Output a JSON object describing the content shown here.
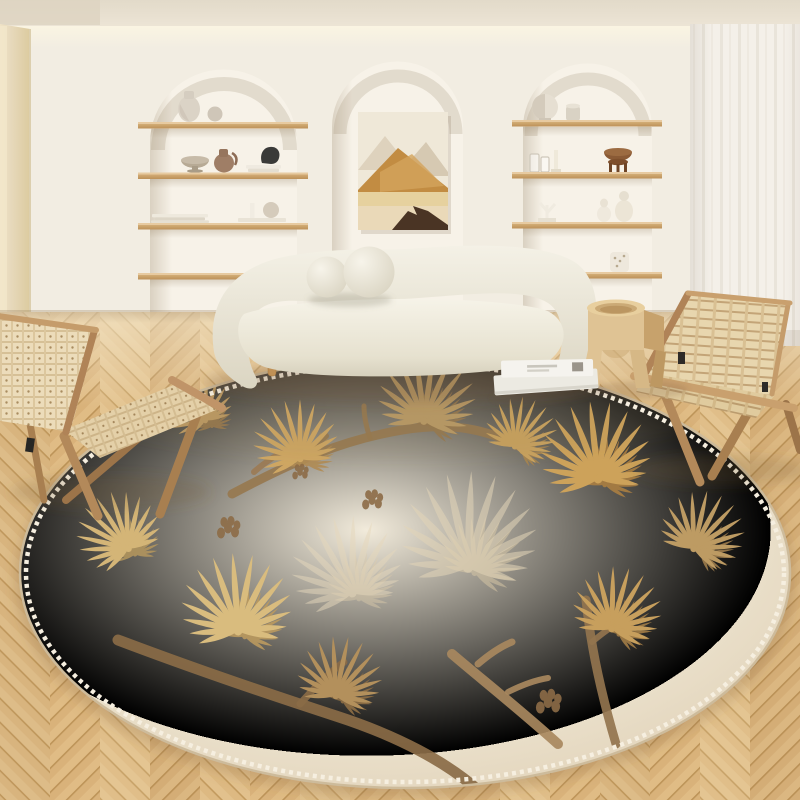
{
  "meta": {
    "description": "Lifestyle photo of a cream Japandi living room: arched wall niches with oak shelves and ceramics, abstract mountain canvas, curved boucle sofa with ball cushions, two wood folding lounge chairs with woven seats, carved wood stool, sheer curtain, herringbone oak parquet, and a large round cream rug with golden pine-branch motifs",
    "visible_text": "none"
  },
  "palette": {
    "ceiling": "#e8e0d1",
    "cove_glow": "#fbf5e2",
    "wall": "#f2ede2",
    "side_wall": "#e7d9bc",
    "niche": "#f7f2e8",
    "shelf_wood": "#cda46e",
    "curtain": "#f4f0e9",
    "floor_mid": "#ddb982",
    "floor_seam": "#c29a5e",
    "rug_base": "#eee5d2",
    "rug_stitch": "#f6efe0",
    "rug_gold": "#cda25a",
    "rug_tan": "#b3905c",
    "rug_brown": "#8a6b46",
    "sofa": "#ece7d9",
    "chair_wood": "#b3895a",
    "weave": "#ead9b6",
    "stool_wood": "#dfc394",
    "magazine": "#f1efe8",
    "art_rock": "#4a3424"
  },
  "objects": {
    "ceiling": {
      "label": "ceiling with recessed cove lighting"
    },
    "wall": {
      "label": "warm white plaster wall"
    },
    "side_wall": {
      "label": "beige side wall at left"
    },
    "niche_left": {
      "label": "arched wall niche with four oak shelves of ceramics",
      "shelves": [
        {
          "items": [
            "white ceramic vase",
            "small sphere vase"
          ]
        },
        {
          "items": [
            "footed stone bowl",
            "brown clay jug",
            "stack of white books",
            "dark abstract sculpture"
          ]
        },
        {
          "items": [
            "stack of books",
            "books with white candle and round vase"
          ]
        },
        {
          "items": [
            "empty shelf behind sofa"
          ]
        }
      ]
    },
    "niche_center": {
      "label": "arched niche with abstract canvas",
      "art": {
        "label": "abstract mountain landscape painting in ochre and cream",
        "colors": [
          "#efe8d8",
          "#ded2bd",
          "#c28c42",
          "#e6d19e",
          "#4a3424"
        ]
      }
    },
    "niche_right": {
      "label": "arched wall niche with four oak shelves of ceramics",
      "shelves": [
        {
          "items": [
            "round disc sculpture",
            "small white pot"
          ]
        },
        {
          "items": [
            "two glass cups",
            "white candle holder",
            "brown footed pedestal bowl"
          ]
        },
        {
          "items": [
            "white branch sculpture",
            "two white gourd vases"
          ]
        },
        {
          "items": [
            "white dotted cup"
          ]
        }
      ]
    },
    "curtain": {
      "label": "floor-length sheer curtain at right"
    },
    "floor": {
      "label": "light oak herringbone parquet floor"
    },
    "rug": {
      "label": "large round cream rug with golden pine branch motif",
      "edge": "whipstitch border",
      "motifs": [
        {
          "x": 300,
          "y": 458,
          "rot": -15,
          "scale": 1.0,
          "color": "#cfa763",
          "color2": "#b18c55"
        },
        {
          "x": 424,
          "y": 420,
          "rot": 8,
          "scale": 1.15,
          "color": "#b99a66",
          "color2": "#97794f"
        },
        {
          "x": 515,
          "y": 446,
          "rot": 24,
          "scale": 0.85,
          "color": "#c9a25f",
          "color2": "#a8854f"
        },
        {
          "x": 598,
          "y": 478,
          "rot": -6,
          "scale": 1.3,
          "color": "#cda25a",
          "color2": "#ab7f42"
        },
        {
          "x": 694,
          "y": 548,
          "rot": 28,
          "scale": 1.0,
          "color": "#bd9b63",
          "color2": "#9d7c4c"
        },
        {
          "x": 128,
          "y": 548,
          "rot": -32,
          "scale": 1.0,
          "color": "#d4b577",
          "color2": "#b2955e"
        },
        {
          "x": 238,
          "y": 630,
          "rot": -4,
          "scale": 1.3,
          "color": "#d9bc7e",
          "color2": "#bb9a5f"
        },
        {
          "x": 336,
          "y": 695,
          "rot": 12,
          "scale": 1.0,
          "color": "#b3905c",
          "color2": "#8f6f45"
        },
        {
          "x": 612,
          "y": 628,
          "rot": 16,
          "scale": 1.05,
          "color": "#c79f5d",
          "color2": "#a37d46"
        },
        {
          "x": 205,
          "y": 420,
          "rot": -28,
          "scale": 0.8,
          "color": "#bd9a64",
          "color2": "#9b7a4e"
        },
        {
          "x": 468,
          "y": 566,
          "rot": 2,
          "scale": 1.6,
          "color": "#e3d5b8",
          "color2": "#dccba8",
          "opacity": 0.55
        },
        {
          "x": 352,
          "y": 592,
          "rot": -14,
          "scale": 1.3,
          "color": "#e6d8bc",
          "color2": "#ddccab",
          "opacity": 0.5
        }
      ],
      "branches": [
        {
          "d": "M232,494 C292,462 342,440 402,430 C452,422 482,428 526,448",
          "w": 9,
          "c": "#97784f"
        },
        {
          "d": "M300,464 C310,450 318,442 326,436",
          "w": 6,
          "c": "#97784f"
        },
        {
          "d": "M370,438 C366,426 364,416 364,406",
          "w": 5,
          "c": "#97784f"
        },
        {
          "d": "M118,640 C192,668 262,692 336,716 C398,736 446,762 478,790",
          "w": 11,
          "c": "#8a6b46"
        },
        {
          "d": "M300,704 C316,686 330,672 344,662",
          "w": 7,
          "c": "#8a6b46"
        },
        {
          "d": "M452,654 C480,678 518,708 558,744",
          "w": 10,
          "c": "#a8885e"
        },
        {
          "d": "M478,664 C492,652 502,646 512,642",
          "w": 7,
          "c": "#a8885e"
        },
        {
          "d": "M508,692 C524,684 536,680 548,678",
          "w": 6,
          "c": "#a8885e"
        },
        {
          "d": "M586,600 C590,640 600,690 616,744",
          "w": 9,
          "c": "#93744e"
        },
        {
          "d": "M592,642 C604,632 612,626 622,622",
          "w": 6,
          "c": "#93744e"
        },
        {
          "d": "M254,472 C272,456 288,448 304,444",
          "w": 6,
          "c": "#9b7b55"
        }
      ],
      "cones": [
        {
          "x": 228,
          "y": 528,
          "scale": 1.0
        },
        {
          "x": 372,
          "y": 500,
          "scale": 0.9
        },
        {
          "x": 548,
          "y": 702,
          "scale": 1.1
        },
        {
          "x": 300,
          "y": 472,
          "scale": 0.7
        }
      ]
    },
    "sofa": {
      "label": "curved cream boucle sofa",
      "cushions": "two round ball cushions",
      "legs": "tapered wood legs"
    },
    "chair_left": {
      "label": "wood folding lounge chair with woven paper-cord seat, facing right"
    },
    "chair_right": {
      "label": "wood folding lounge chair with woven webbing seat, facing left"
    },
    "stool": {
      "label": "carved wood side stool with arched cutouts"
    },
    "magazines": {
      "label": "two magazines lying on the rug"
    }
  }
}
